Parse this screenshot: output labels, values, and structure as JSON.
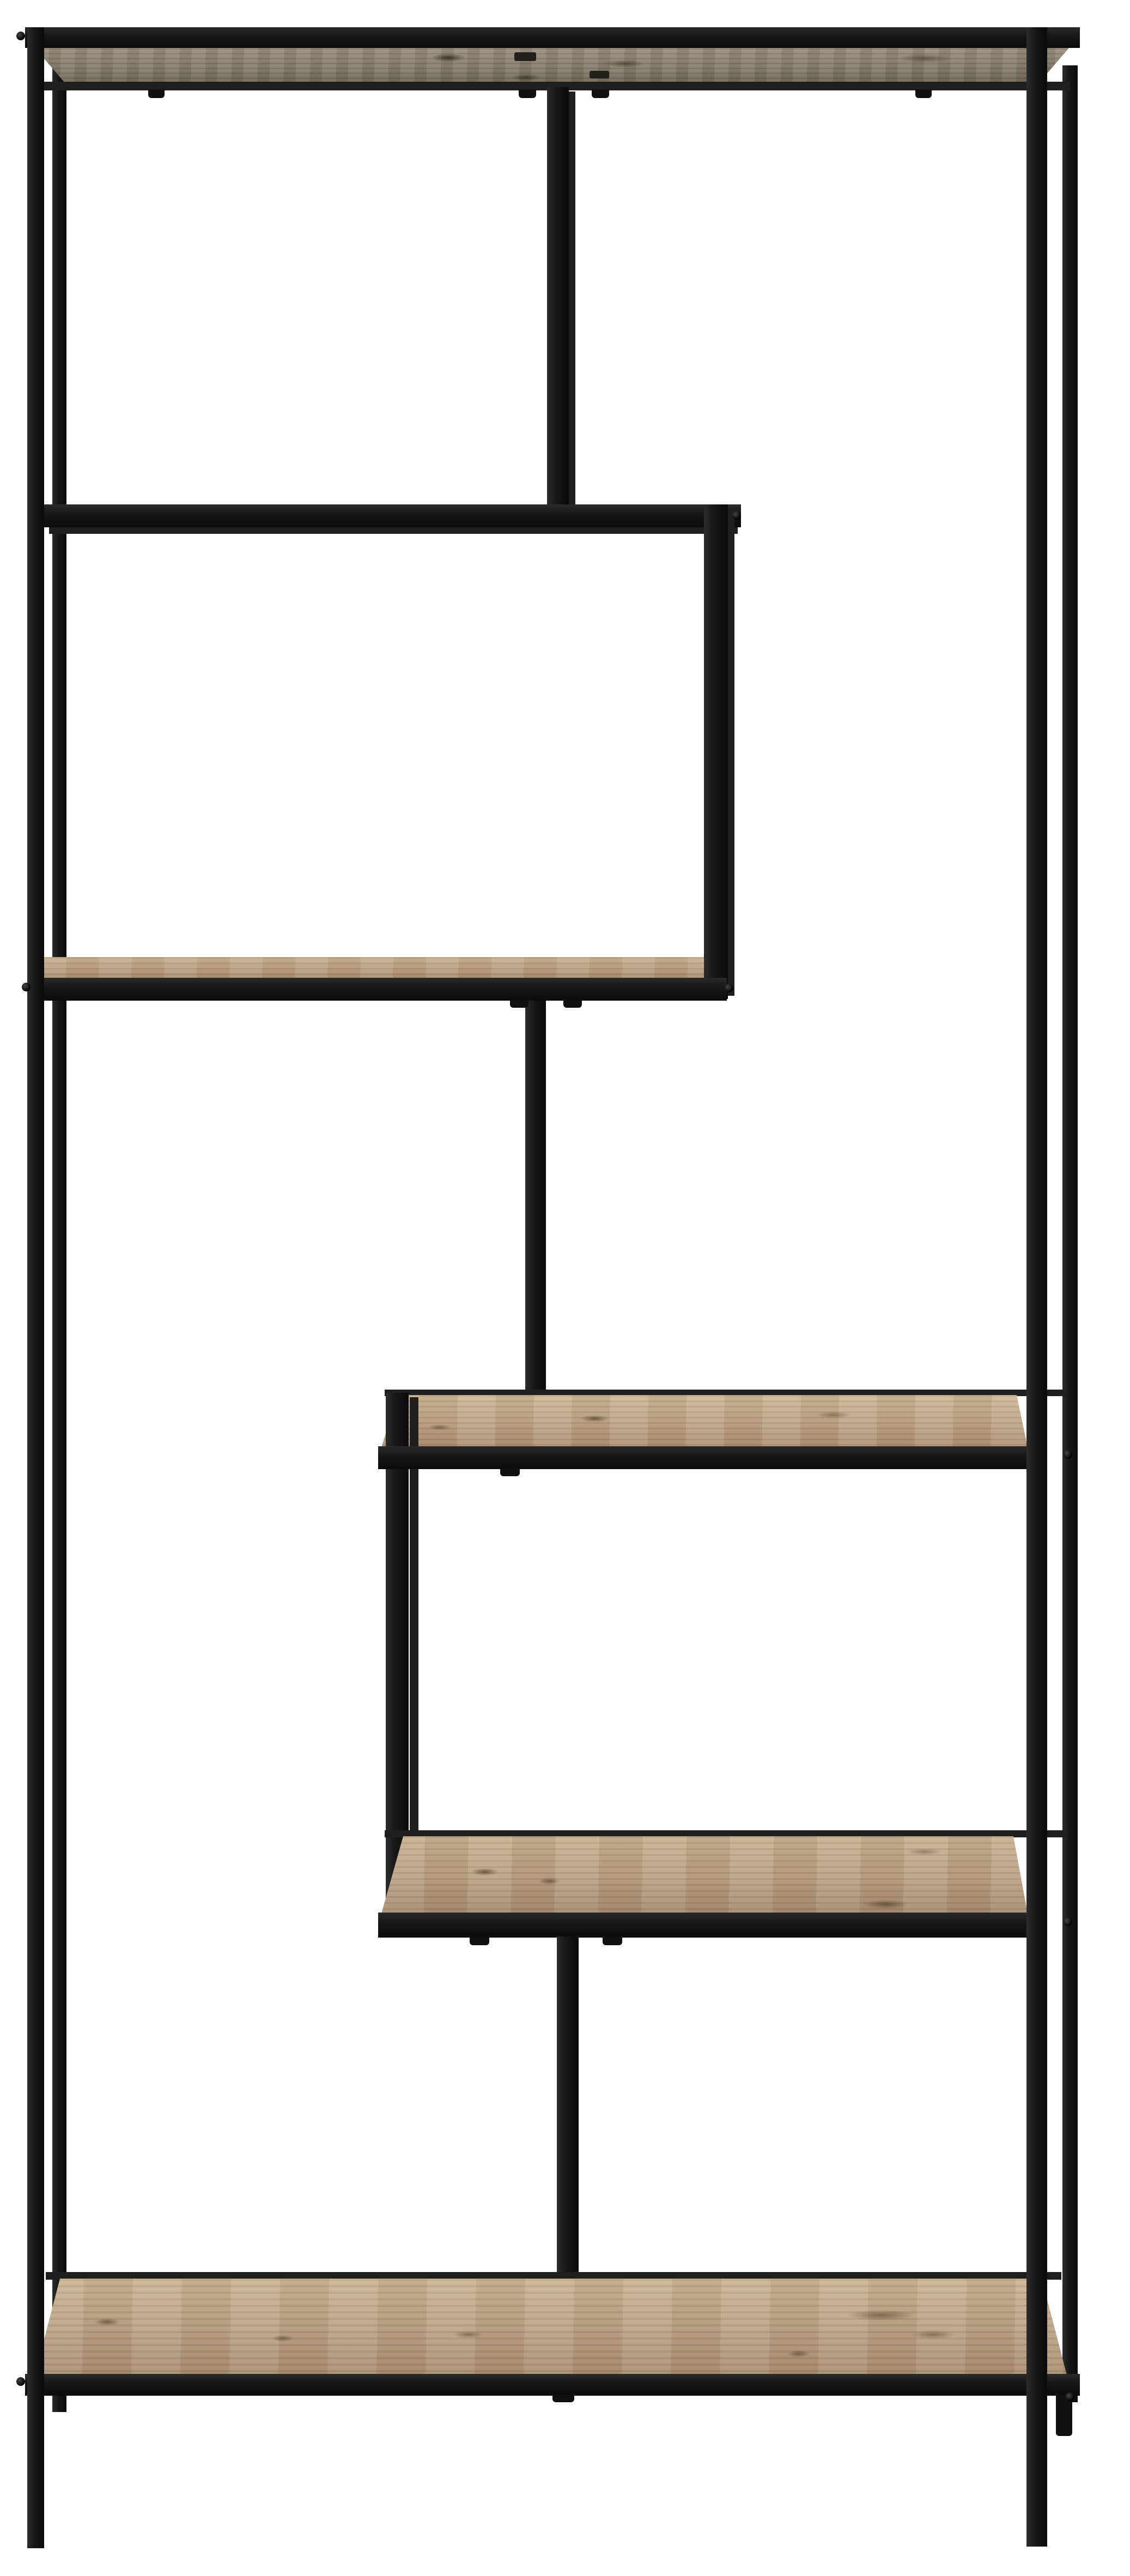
{
  "meta": {
    "type": "product-photo",
    "description": "Tall asymmetric etagere bookcase with a thin black metal frame and five oak-look wood shelves, photographed on a plain white studio background",
    "shelf_count": 5
  },
  "colors": {
    "background": "#ffffff",
    "metal": "#161616",
    "metal-highlight": "#2c2c2c",
    "wood-light": "#ccb493",
    "wood-mid": "#b79c7d",
    "wood-dark": "#9c8465",
    "wood-knot": "#5f4e3c",
    "wood-underside": "#877c6b"
  },
  "parts": {
    "frame": "black metal frame",
    "top_shelf": "top shelf",
    "upper_shelf": "upper left shelf",
    "middle_top_shelf": "middle shelf",
    "middle_bottom_shelf": "lower middle shelf",
    "bottom_shelf": "bottom shelf"
  }
}
